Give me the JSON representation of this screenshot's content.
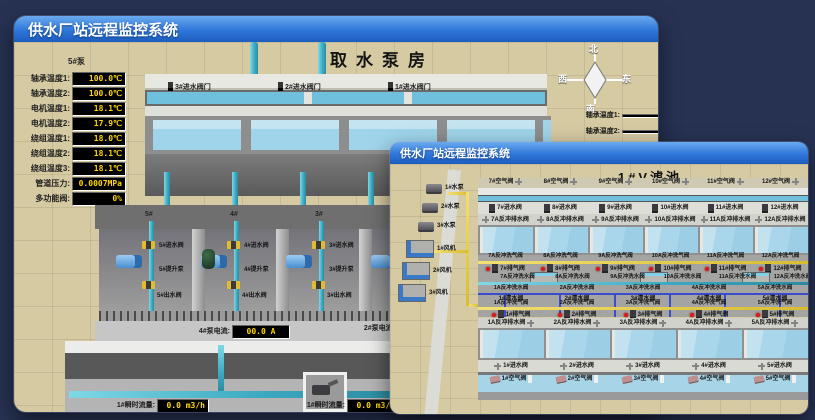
{
  "colors": {
    "desktop_bg": "#273253",
    "titlebar_top": "#6aaaf0",
    "titlebar_bottom": "#1d5dc0",
    "ground": "#d5caa2",
    "water": "#a9d6ea",
    "pipe_cyan": "#49b8cc",
    "pipe_yellow": "#e8d44c",
    "pipe_blue": "#3a4ecc",
    "valve_yellow": "#e0bc2e",
    "alarm_red": "#e01818",
    "readout_bg": "#000000",
    "readout_text": "#ffd800"
  },
  "win1": {
    "title": "供水厂站远程监控系统",
    "scene_title": "取水泵房",
    "sensor_panel": {
      "header": "5#泵",
      "rows": [
        {
          "label": "轴承温度1:",
          "value": "100.0℃"
        },
        {
          "label": "轴承温度2:",
          "value": "100.0℃"
        },
        {
          "label": "电机温度1:",
          "value": "18.1℃"
        },
        {
          "label": "电机温度2:",
          "value": "17.9℃"
        },
        {
          "label": "绕组温度1:",
          "value": "18.0℃"
        },
        {
          "label": "绕组温度2:",
          "value": "18.1℃"
        },
        {
          "label": "绕组温度3:",
          "value": "18.1℃"
        },
        {
          "label": "管道压力:",
          "value": "0.0007MPa"
        },
        {
          "label": "多功能阀:",
          "value": "0%"
        }
      ]
    },
    "intake_valves": [
      "3#进水阀门",
      "2#进水阀门",
      "1#进水阀门"
    ],
    "compass": {
      "n": "北",
      "w": "西",
      "s": "南",
      "e": "东"
    },
    "side_readouts": [
      {
        "label": "轴承温度1:"
      },
      {
        "label": "轴承温度2:"
      }
    ],
    "bays": [
      {
        "num": "5#",
        "inlet": "5#进水阀",
        "pump": "5#提升泵",
        "outlet": "5#出水阀"
      },
      {
        "num": "4#",
        "inlet": "4#进水阀",
        "pump": "4#提升泵",
        "outlet": "4#出水阀"
      },
      {
        "num": "3#",
        "inlet": "3#进水阀",
        "pump": "3#提升泵",
        "outlet": "3#出水阀"
      },
      {
        "num": "2#"
      }
    ],
    "current_readouts": [
      {
        "label": "4#泵电流:",
        "value": "00.0 A"
      },
      {
        "label": "2#泵电流:"
      }
    ],
    "flow_readouts": [
      {
        "label": "1#瞬时流量:",
        "value": "0.0 m3/h"
      },
      {
        "label": "1#瞬时流量:",
        "value": "0.0 m3/h"
      }
    ]
  },
  "win2": {
    "title": "供水厂站远程监控系统",
    "scene_title": "1#V滤池",
    "pumps": [
      "1#水泵",
      "2#水泵",
      "3#水泵"
    ],
    "blowers": [
      "1#风机",
      "2#风机",
      "3#风机"
    ],
    "top_air": [
      "7#空气阀",
      "8#空气阀",
      "9#空气阀",
      "10#空气阀",
      "11#空气阀",
      "12#空气阀"
    ],
    "top_inlet": [
      "7#进水阀",
      "8#进水阀",
      "9#进水阀",
      "10#进水阀",
      "11#进水阀",
      "12#进水阀"
    ],
    "top_drain": [
      "7A反冲排水阀",
      "8A反冲排水阀",
      "9A反冲排水阀",
      "10A反冲排水阀",
      "11A反冲排水阀",
      "12A反冲排水阀"
    ],
    "gal_wash_air_top": [
      "7A反冲洗气阀",
      "8A反冲洗气阀",
      "9A反冲洗气阀",
      "10A反冲洗气阀",
      "11A反冲洗气阀",
      "12A反冲洗气阀"
    ],
    "gal_exhaust_top": [
      "7#排气阀",
      "8#排气阀",
      "9#排气阀",
      "10#排气阀",
      "11#排气阀",
      "12#排气阀"
    ],
    "gal_wash_water_top": [
      "7A反冲洗水阀",
      "8A反冲洗水阀",
      "9A反冲洗水阀",
      "10A反冲洗水阀",
      "11A反冲洗水阀",
      "12A反冲洗水阀"
    ],
    "gal_wash_water_bot": [
      "1A反冲洗水阀",
      "2A反冲洗水阀",
      "3A反冲洗水阀",
      "4A反冲洗水阀",
      "5A反冲洗水阀"
    ],
    "gal_clean": [
      "1#清水阀",
      "2#清水阀",
      "3#清水阀",
      "4#清水阀",
      "5#清水阀"
    ],
    "gal_wash_air_bot": [
      "1A反冲洗气阀",
      "2A反冲洗气阀",
      "3A反冲洗气阀",
      "4A反冲洗气阀",
      "5A反冲洗气阀"
    ],
    "gal_exhaust_bot": [
      "1#排气阀",
      "2#排气阀",
      "3#排气阀",
      "4#排气阀",
      "5#排气阀"
    ],
    "bot_drain": [
      "1A反冲排水阀",
      "2A反冲排水阀",
      "3A反冲排水阀",
      "4A反冲排水阀",
      "5A反冲排水阀"
    ],
    "bot_inlet": [
      "1#进水阀",
      "2#进水阀",
      "3#进水阀",
      "4#进水阀",
      "5#进水阀"
    ],
    "bot_air": [
      "1#空气阀",
      "2#空气阀",
      "3#空气阀",
      "4#空气阀",
      "5#空气阀"
    ]
  }
}
